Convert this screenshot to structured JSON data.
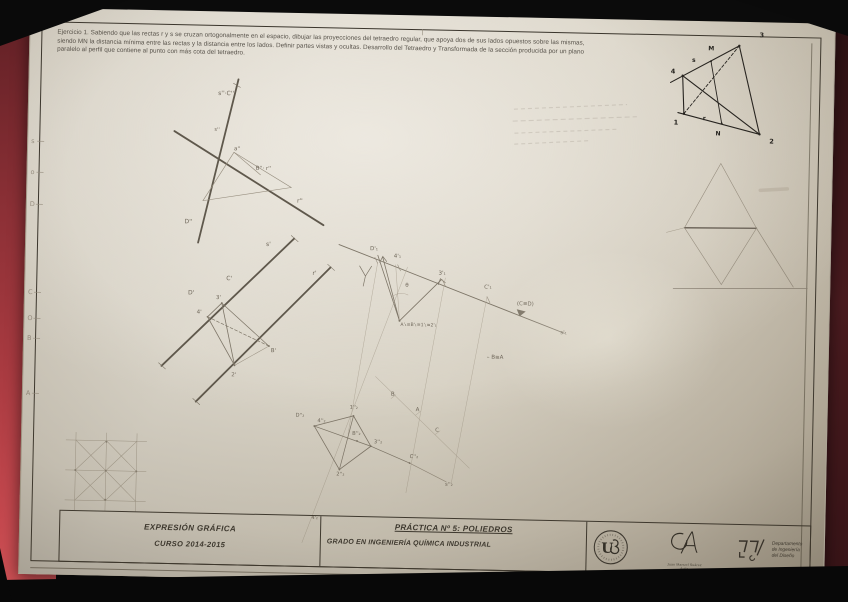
{
  "colors": {
    "backdrop": "#0d0d0d",
    "folder_red": "#a83a40",
    "paper": "#d6d0c3",
    "print_ink": "#3a352c",
    "pencil": "#6f675a"
  },
  "exercise": {
    "lines": [
      "Ejercicio 1. Sabiendo que las rectas r y s se cruzan ortogonalmente en el espacio, dibujar las proyecciones del tetraedro regular, que apoya dos de sus lados opuestos sobre las mismas,",
      "siendo MN la distancia mínima entre las rectas y la distancia entre los lados. Definir partes vistas y ocultas. Desarrollo del Tetraedro y Transformada de la sección producida por un plano",
      "paralelo al perfil que contiene al punto con más cota del tetraedro."
    ]
  },
  "title_block": {
    "subject": "EXPRESIÓN GRÁFICA",
    "year": "CURSO 2014-2015",
    "practice": "PRÁCTICA Nº 5: POLIEDROS",
    "degree": "GRADO EN INGENIERÍA QUÍMICA INDUSTRIAL"
  },
  "logos": {
    "seal_text": "US",
    "signature_caption_1": "Juan Manuel Suárez",
    "signature_caption_2": "Ávila",
    "dept_line_1": "Departamento",
    "dept_line_2": "de Ingeniería",
    "dept_line_3": "del Diseño"
  },
  "labels": {
    "ink": [
      {
        "x": 729,
        "y": 15,
        "t": "3",
        "s": 6.5
      },
      {
        "x": 678,
        "y": 29,
        "t": "M",
        "s": 6
      },
      {
        "x": 641,
        "y": 53,
        "t": "4",
        "s": 6.5
      },
      {
        "x": 662,
        "y": 41,
        "t": "s",
        "s": 6
      },
      {
        "x": 645,
        "y": 104,
        "t": "1",
        "s": 6.5
      },
      {
        "x": 674,
        "y": 99,
        "t": "r",
        "s": 6
      },
      {
        "x": 687,
        "y": 114,
        "t": "N",
        "s": 6
      },
      {
        "x": 741,
        "y": 121,
        "t": "2",
        "s": 6.5
      }
    ],
    "pencil": [
      {
        "x": 189,
        "y": 84,
        "t": "s''·C''",
        "s": 6
      },
      {
        "x": 186,
        "y": 120,
        "t": "s''",
        "s": 5
      },
      {
        "x": 206,
        "y": 139,
        "t": "a''",
        "s": 5.5
      },
      {
        "x": 228,
        "y": 158,
        "t": "B''· r''",
        "s": 5.5
      },
      {
        "x": 158,
        "y": 213,
        "t": "D''",
        "s": 6
      },
      {
        "x": 270,
        "y": 190,
        "t": "r''",
        "s": 6
      },
      {
        "x": 240,
        "y": 234,
        "t": "s'",
        "s": 6
      },
      {
        "x": 287,
        "y": 262,
        "t": "r'",
        "s": 6
      },
      {
        "x": 201,
        "y": 269,
        "t": "C'",
        "s": 6
      },
      {
        "x": 163,
        "y": 284,
        "t": "D'",
        "s": 6
      },
      {
        "x": 191,
        "y": 288,
        "t": "3'",
        "s": 5.5
      },
      {
        "x": 172,
        "y": 303,
        "t": "4'",
        "s": 5.5
      },
      {
        "x": 247,
        "y": 340,
        "t": "B'",
        "s": 5.5
      },
      {
        "x": 208,
        "y": 365,
        "t": "2'",
        "s": 5.5
      },
      {
        "x": 344,
        "y": 236,
        "t": "D'₁",
        "s": 5.5
      },
      {
        "x": 368,
        "y": 243,
        "t": "4'₁",
        "s": 5.5
      },
      {
        "x": 413,
        "y": 259,
        "t": "3'₁",
        "s": 5.5
      },
      {
        "x": 459,
        "y": 272,
        "t": "C'₁",
        "s": 5.5
      },
      {
        "x": 492,
        "y": 288,
        "t": "(C≡D)",
        "s": 5.5
      },
      {
        "x": 536,
        "y": 316,
        "t": "s'₁",
        "s": 5.5
      },
      {
        "x": 380,
        "y": 272,
        "t": "θ",
        "s": 5.5
      },
      {
        "x": 376,
        "y": 311,
        "t": "A'₁≡B'₁≡1'₁≡2'₁",
        "s": 4.6
      },
      {
        "x": 463,
        "y": 342,
        "t": "– B≡A",
        "s": 5.5
      },
      {
        "x": 273,
        "y": 404,
        "t": "D''₂",
        "s": 5.2
      },
      {
        "x": 295,
        "y": 409,
        "t": "4''₂",
        "s": 5.2
      },
      {
        "x": 327,
        "y": 395,
        "t": "1''₂",
        "s": 5.2
      },
      {
        "x": 330,
        "y": 421,
        "t": "B''₂",
        "s": 5.2
      },
      {
        "x": 352,
        "y": 429,
        "t": "3''₂",
        "s": 5.2
      },
      {
        "x": 315,
        "y": 462,
        "t": "2''₂",
        "s": 5.2
      },
      {
        "x": 388,
        "y": 443,
        "t": "C''₂",
        "s": 5.2
      },
      {
        "x": 424,
        "y": 470,
        "t": "s''₂",
        "s": 5.2
      },
      {
        "x": 368,
        "y": 381,
        "t": "B",
        "s": 5.5
      },
      {
        "x": 393,
        "y": 396,
        "t": "A",
        "s": 5.5
      },
      {
        "x": 413,
        "y": 416,
        "t": "C",
        "s": 5.5
      },
      {
        "x": 291,
        "y": 506,
        "t": "4'₂",
        "s": 5
      }
    ],
    "margin": [
      {
        "x": 3,
        "y": 136,
        "t": "s",
        "s": 6.5
      },
      {
        "x": 3,
        "y": 167,
        "t": "o",
        "s": 6.5
      },
      {
        "x": 3,
        "y": 199,
        "t": "D",
        "s": 6.5
      },
      {
        "x": 3,
        "y": 287,
        "t": "C",
        "s": 6.5
      },
      {
        "x": 3,
        "y": 313,
        "t": "O",
        "s": 6.5
      },
      {
        "x": 3,
        "y": 333,
        "t": "B",
        "s": 6.5
      },
      {
        "x": 3,
        "y": 388,
        "t": "A",
        "s": 6.5
      }
    ]
  }
}
